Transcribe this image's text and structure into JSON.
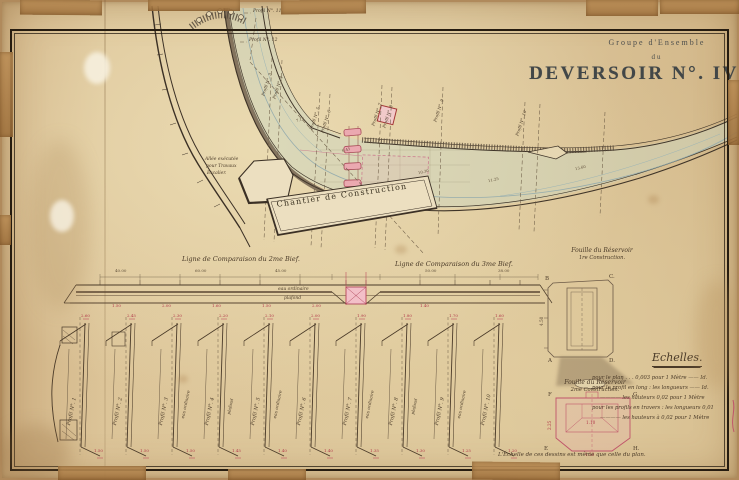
{
  "title_block": {
    "line1": "Groupe d'Ensemble",
    "line2": "du",
    "line3": "DEVERSOIR N°. IV"
  },
  "plan": {
    "yard_label": "Chantier de Construction",
    "allee_note": {
      "l1": "Allée exécutée",
      "l2": "pour Travaux",
      "l3": "Escalier."
    },
    "markers": {
      "m11": "Profil N°. 11",
      "m12": "Profil N°. 12",
      "m3": "Profil N°. 3",
      "m4": "Profil N°. 4",
      "m5": "Profil N°. 5",
      "m6": "Profil N°. 6",
      "m7": "Profil N°. 7",
      "m8": "Profil N°. 8",
      "m9": "Profil N°. 9",
      "m10": "Profil N°. 10"
    },
    "spots": {
      "s1": "7.12",
      "s2": "6.45",
      "s3": "10.30",
      "s4": "11.25",
      "s5": "13.60"
    }
  },
  "long_profile": {
    "left_title": "Ligne de Comparaison du 2me Bief.",
    "right_title": "Ligne de Comparaison du 3me Bief.",
    "water": "eau ordinaire",
    "bed": "plafond",
    "top_dims": [
      "40.00",
      "60.00",
      "45.00",
      "50.00",
      "38.00"
    ],
    "red_dims": [
      "1.50",
      "2.00",
      "1.60",
      "1.50",
      "2.00",
      "1.40"
    ]
  },
  "fouille1": {
    "t1": "Fouille du Réservoir",
    "t2": "1re Construction.",
    "cb": "B",
    "cc": "C.",
    "ca": "A",
    "cd": "D.",
    "dim": "4.50"
  },
  "fouille2": {
    "t1": "Fouille du Réservoir",
    "t2": "2me Construction.",
    "cf": "F",
    "cg": "G.",
    "ce": "E",
    "ch": "H.",
    "dim_w": "4.50",
    "dim_h": "2.25",
    "dim_i": "1.10"
  },
  "echelles": {
    "heading": "Echelles.",
    "lines": [
      "pour le plan . . . 0,003 pour 1 Mètre —— Id.",
      "pour le profil en long : les longueurs —— Id.",
      "———— les hauteurs 0,02 pour 1 Mètre",
      "pour les profils en travers : les longueurs 0,01",
      "———— les hauteurs à 0,02 pour 1 Mètre"
    ]
  },
  "bottom_note": "L'Échelle de ces dessins est même que celle du plan.",
  "profiles": {
    "items": [
      {
        "label": "Profil N°. 1",
        "top": "2.60",
        "bottom": "1.50"
      },
      {
        "label": "Profil N°. 2",
        "top": "2.45",
        "bottom": "1.50"
      },
      {
        "label": "Profil N°. 3",
        "top": "2.30",
        "bottom": "1.50"
      },
      {
        "label": "Profil N°. 4",
        "top": "2.20",
        "bottom": "1.45"
      },
      {
        "label": "Profil N°. 5",
        "top": "2.10",
        "bottom": "1.40"
      },
      {
        "label": "Profil N°. 6",
        "top": "2.00",
        "bottom": "1.40"
      },
      {
        "label": "Profil N°. 7",
        "top": "1.90",
        "bottom": "1.35"
      },
      {
        "label": "Profil N°. 8",
        "top": "1.80",
        "bottom": "1.30"
      },
      {
        "label": "Profil N°. 9",
        "top": "1.70",
        "bottom": "1.25"
      },
      {
        "label": "Profil N°. 10",
        "top": "1.60",
        "bottom": "1.20"
      }
    ]
  }
}
